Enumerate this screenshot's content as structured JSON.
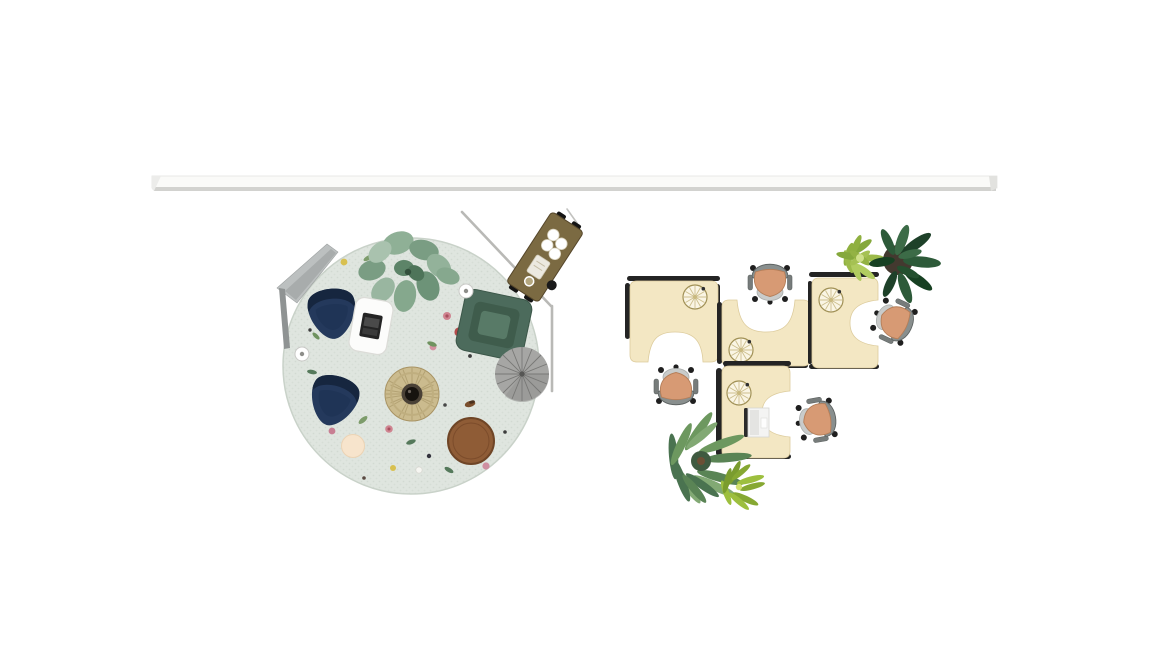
{
  "scene": {
    "description": "Top-down interior floor plan rendering: lounge area with circular floral rug on the left, four-desk workstation cluster on the right, long wall segment across the top",
    "areas": {
      "wall": {
        "label": "long wall / beam segment"
      },
      "lounge": {
        "label": "lounge area",
        "items": [
          "circular floral rug",
          "navy lounge chair upper",
          "navy lounge chair lower",
          "white coffee table with laptop",
          "green square armchair",
          "rattan drum table",
          "gray round side table",
          "brown round side table",
          "cream round stool",
          "small white disc table right",
          "small white disc table left",
          "large leafy potted plant",
          "gray angular floor lamp",
          "diagonal wall partition",
          "mobile bar cart"
        ]
      },
      "workstations": {
        "label": "desk cluster",
        "items": [
          "L-desk left",
          "L-desk middle",
          "L-desk right",
          "L-desk bottom",
          "task chair top",
          "task chair right",
          "task chair left",
          "task chair bottom",
          "wheel decor on each desk",
          "white laptop on bottom desk",
          "bromeliad plant",
          "monstera potted plant",
          "large fern plant",
          "small palm plant"
        ]
      }
    }
  },
  "colors": {
    "wall_face": "#fafaf8",
    "wall_shadow": "#d2d2cf",
    "rug": "#dfe5df",
    "rug_edge": "#c9d2c9",
    "navy_chair": "#24395c",
    "navy_chair_dark": "#16263f",
    "coffee_table": "#fcfcfb",
    "laptop_black": "#242424",
    "green_armchair": "#4c6b5c",
    "green_armchair_dark": "#3f5c4c",
    "green_armchair_seat": "#587a67",
    "rattan": "#cbbb8e",
    "rattan_center": "#17130f",
    "umbrella_table": "#a6a6a4",
    "brown_table": "#8f5c36",
    "cream_stool": "#f7e4cc",
    "cart_body": "#7b6a42",
    "desk": "#f3e7c3",
    "desk_edge": "#242424",
    "chair_seat": "#d79a74",
    "chair_frame": "#898f8e",
    "wheel_face": "#faf5e4",
    "lamp_gray": "#bcc0c0",
    "partition_line": "#b9b9b6",
    "plant_sage": "#85a88d",
    "plant_dark": "#24502f",
    "plant_light": "#9cba4a",
    "fern_green": "#6d985f"
  }
}
